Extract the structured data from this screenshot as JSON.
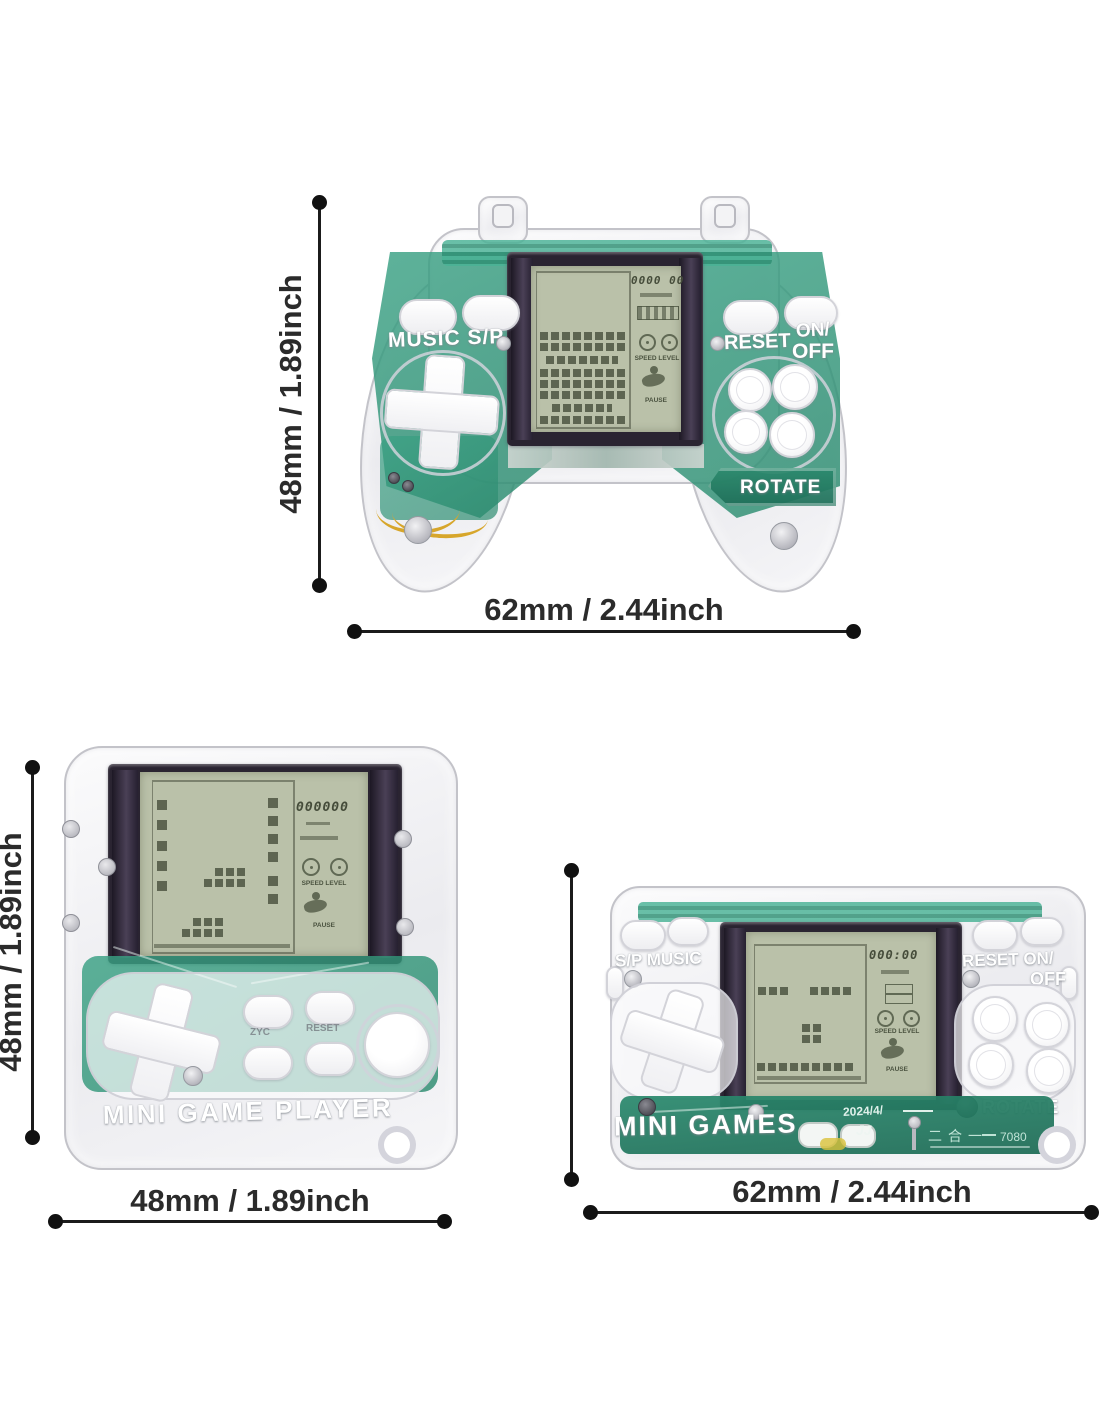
{
  "dim_labels": {
    "gamepad_h": "48mm / 1.89inch",
    "gamepad_w": "62mm / 2.44inch",
    "square_h": "48mm / 1.89inch",
    "square_w": "48mm / 1.89inch",
    "wide_w": "62mm / 2.44inch"
  },
  "gamepad": {
    "music": "MUSIC S/P",
    "reset": "RESET",
    "on": "ON/",
    "off": "OFF",
    "rotate": "ROTATE",
    "score": "0000 00",
    "speed": "SPEED LEVEL",
    "pause": "PAUSE"
  },
  "square": {
    "name": "MINI GAME PLAYER",
    "score": "000000",
    "speed": "SPEED LEVEL",
    "pause": "PAUSE",
    "btn_left": "ZYC",
    "btn_right": "RESET"
  },
  "wide": {
    "name": "MINI GAMES",
    "sp_music": "S/P MUSIC",
    "reset_on": "RESET ON/",
    "off": "OFF",
    "rotate": "ROTATE",
    "score": "000:00",
    "speed": "SPEED LEVEL",
    "pause": "PAUSE",
    "pcb_date": "2024/4/",
    "pcb_jj": "JJ",
    "pcb_cn": "二合一",
    "pcb_model": "7080"
  },
  "colors": {
    "pcb_teal": "#2e9378",
    "pcb_dark": "#1e7a61",
    "lcd_bg": "#bac1a9",
    "lcd_ink": "#4a523f",
    "dim_ink": "#2b2b2b"
  }
}
